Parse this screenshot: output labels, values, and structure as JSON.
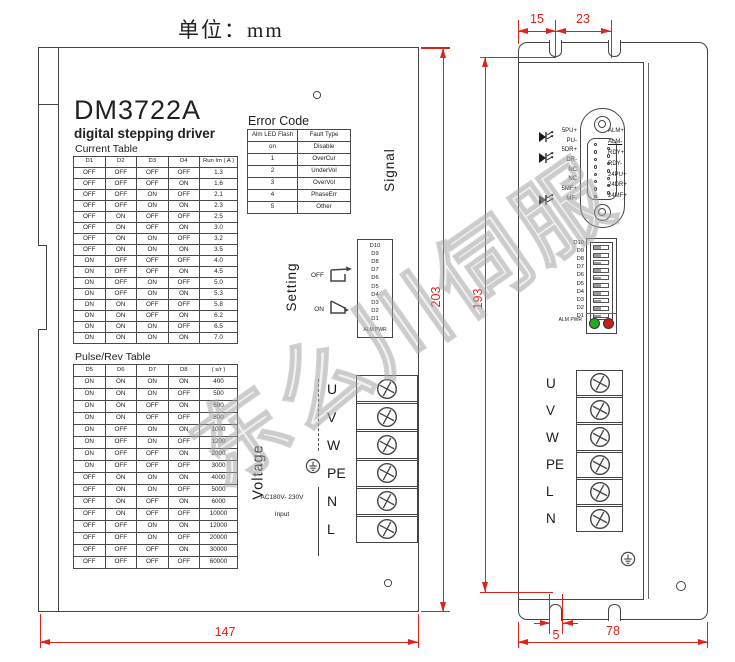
{
  "unit_label": "单位：mm",
  "watermark": "东么川伺服",
  "colors": {
    "line": "#454545",
    "dimension_red": "#e02318",
    "led_green": "#1faa1f",
    "led_red": "#cc1c1c"
  },
  "left_view": {
    "title": "DM3722A",
    "subtitle": "digital stepping driver",
    "current_table": {
      "label": "Current Table",
      "headers": [
        "D1",
        "D2",
        "D3",
        "D4",
        "Run Im ( A )"
      ],
      "rows": [
        [
          "OFF",
          "OFF",
          "OFF",
          "OFF",
          "1.3"
        ],
        [
          "OFF",
          "OFF",
          "OFF",
          "ON",
          "1.6"
        ],
        [
          "OFF",
          "OFF",
          "ON",
          "OFF",
          "2.1"
        ],
        [
          "OFF",
          "OFF",
          "ON",
          "ON",
          "2.3"
        ],
        [
          "OFF",
          "ON",
          "OFF",
          "OFF",
          "2.5"
        ],
        [
          "OFF",
          "ON",
          "OFF",
          "ON",
          "3.0"
        ],
        [
          "OFF",
          "ON",
          "ON",
          "OFF",
          "3.2"
        ],
        [
          "OFF",
          "ON",
          "ON",
          "ON",
          "3.5"
        ],
        [
          "ON",
          "OFF",
          "OFF",
          "OFF",
          "4.0"
        ],
        [
          "ON",
          "OFF",
          "OFF",
          "ON",
          "4.5"
        ],
        [
          "ON",
          "OFF",
          "ON",
          "OFF",
          "5.0"
        ],
        [
          "ON",
          "OFF",
          "ON",
          "ON",
          "5.3"
        ],
        [
          "ON",
          "ON",
          "OFF",
          "OFF",
          "5.8"
        ],
        [
          "ON",
          "ON",
          "OFF",
          "ON",
          "6.2"
        ],
        [
          "ON",
          "ON",
          "ON",
          "OFF",
          "6.5"
        ],
        [
          "ON",
          "ON",
          "ON",
          "ON",
          "7.0"
        ]
      ]
    },
    "pulse_table": {
      "label": "Pulse/Rev Table",
      "headers": [
        "D5",
        "D6",
        "D7",
        "D8",
        "( s/r )"
      ],
      "rows": [
        [
          "ON",
          "ON",
          "ON",
          "ON",
          "400"
        ],
        [
          "ON",
          "ON",
          "ON",
          "OFF",
          "500"
        ],
        [
          "ON",
          "ON",
          "OFF",
          "ON",
          "600"
        ],
        [
          "ON",
          "ON",
          "OFF",
          "OFF",
          "800"
        ],
        [
          "ON",
          "OFF",
          "ON",
          "ON",
          "1000"
        ],
        [
          "ON",
          "OFF",
          "ON",
          "OFF",
          "1200"
        ],
        [
          "ON",
          "OFF",
          "OFF",
          "ON",
          "2000"
        ],
        [
          "ON",
          "OFF",
          "OFF",
          "OFF",
          "3000"
        ],
        [
          "OFF",
          "ON",
          "ON",
          "ON",
          "4000"
        ],
        [
          "OFF",
          "ON",
          "ON",
          "OFF",
          "5000"
        ],
        [
          "OFF",
          "ON",
          "OFF",
          "ON",
          "6000"
        ],
        [
          "OFF",
          "ON",
          "OFF",
          "OFF",
          "10000"
        ],
        [
          "OFF",
          "OFF",
          "ON",
          "ON",
          "12000"
        ],
        [
          "OFF",
          "OFF",
          "ON",
          "OFF",
          "20000"
        ],
        [
          "OFF",
          "OFF",
          "OFF",
          "ON",
          "30000"
        ],
        [
          "OFF",
          "OFF",
          "OFF",
          "OFF",
          "60000"
        ]
      ]
    },
    "error_table": {
      "label": "Error Code",
      "headers": [
        "Alm LED Flash",
        "Fault Type"
      ],
      "rows": [
        [
          "on",
          "Disable"
        ],
        [
          "1",
          "OverCur"
        ],
        [
          "2",
          "UnderVol"
        ],
        [
          "3",
          "OverVol"
        ],
        [
          "4",
          "PhaseErr"
        ],
        [
          "5",
          "Other"
        ]
      ]
    },
    "signal_label": "Signal",
    "setting_label": "Setting",
    "switch_off_label": "OFF",
    "switch_on_label": "ON",
    "dip_legend": [
      "D10",
      "D9",
      "D8",
      "D7",
      "D6",
      "D5",
      "D4",
      "D3",
      "D2",
      "D1"
    ],
    "dip_legend_bottom": "ALM PWR",
    "voltage_label": "Voltage",
    "terminal_labels": [
      "U",
      "V",
      "W",
      "PE",
      "N",
      "L"
    ],
    "input_label_line1": "AC180V- 230V",
    "input_label_line2": "Input"
  },
  "right_view": {
    "connector_left_labels": [
      "5PU+",
      "PU-",
      "5DR+",
      "DR-",
      "NC",
      "NC",
      "5MF+",
      "MF-"
    ],
    "connector_right_labels": [
      "ALM+",
      "ALM-",
      "RDY+",
      "RDY-",
      "24PU+",
      "24DR+",
      "24MF+"
    ],
    "dip_labels": [
      "D10",
      "D9",
      "D8",
      "D7",
      "D6",
      "D5",
      "D4",
      "D3",
      "D2",
      "D1"
    ],
    "led_label": "ALM PWR",
    "terminal_labels": [
      "U",
      "V",
      "W",
      "PE",
      "L",
      "N"
    ]
  },
  "dimensions": {
    "top_left": "15",
    "top_right": "23",
    "left_height": "203",
    "right_height": "193",
    "bottom_left_width": "147",
    "slot_width": "5",
    "bottom_right_width": "78"
  }
}
